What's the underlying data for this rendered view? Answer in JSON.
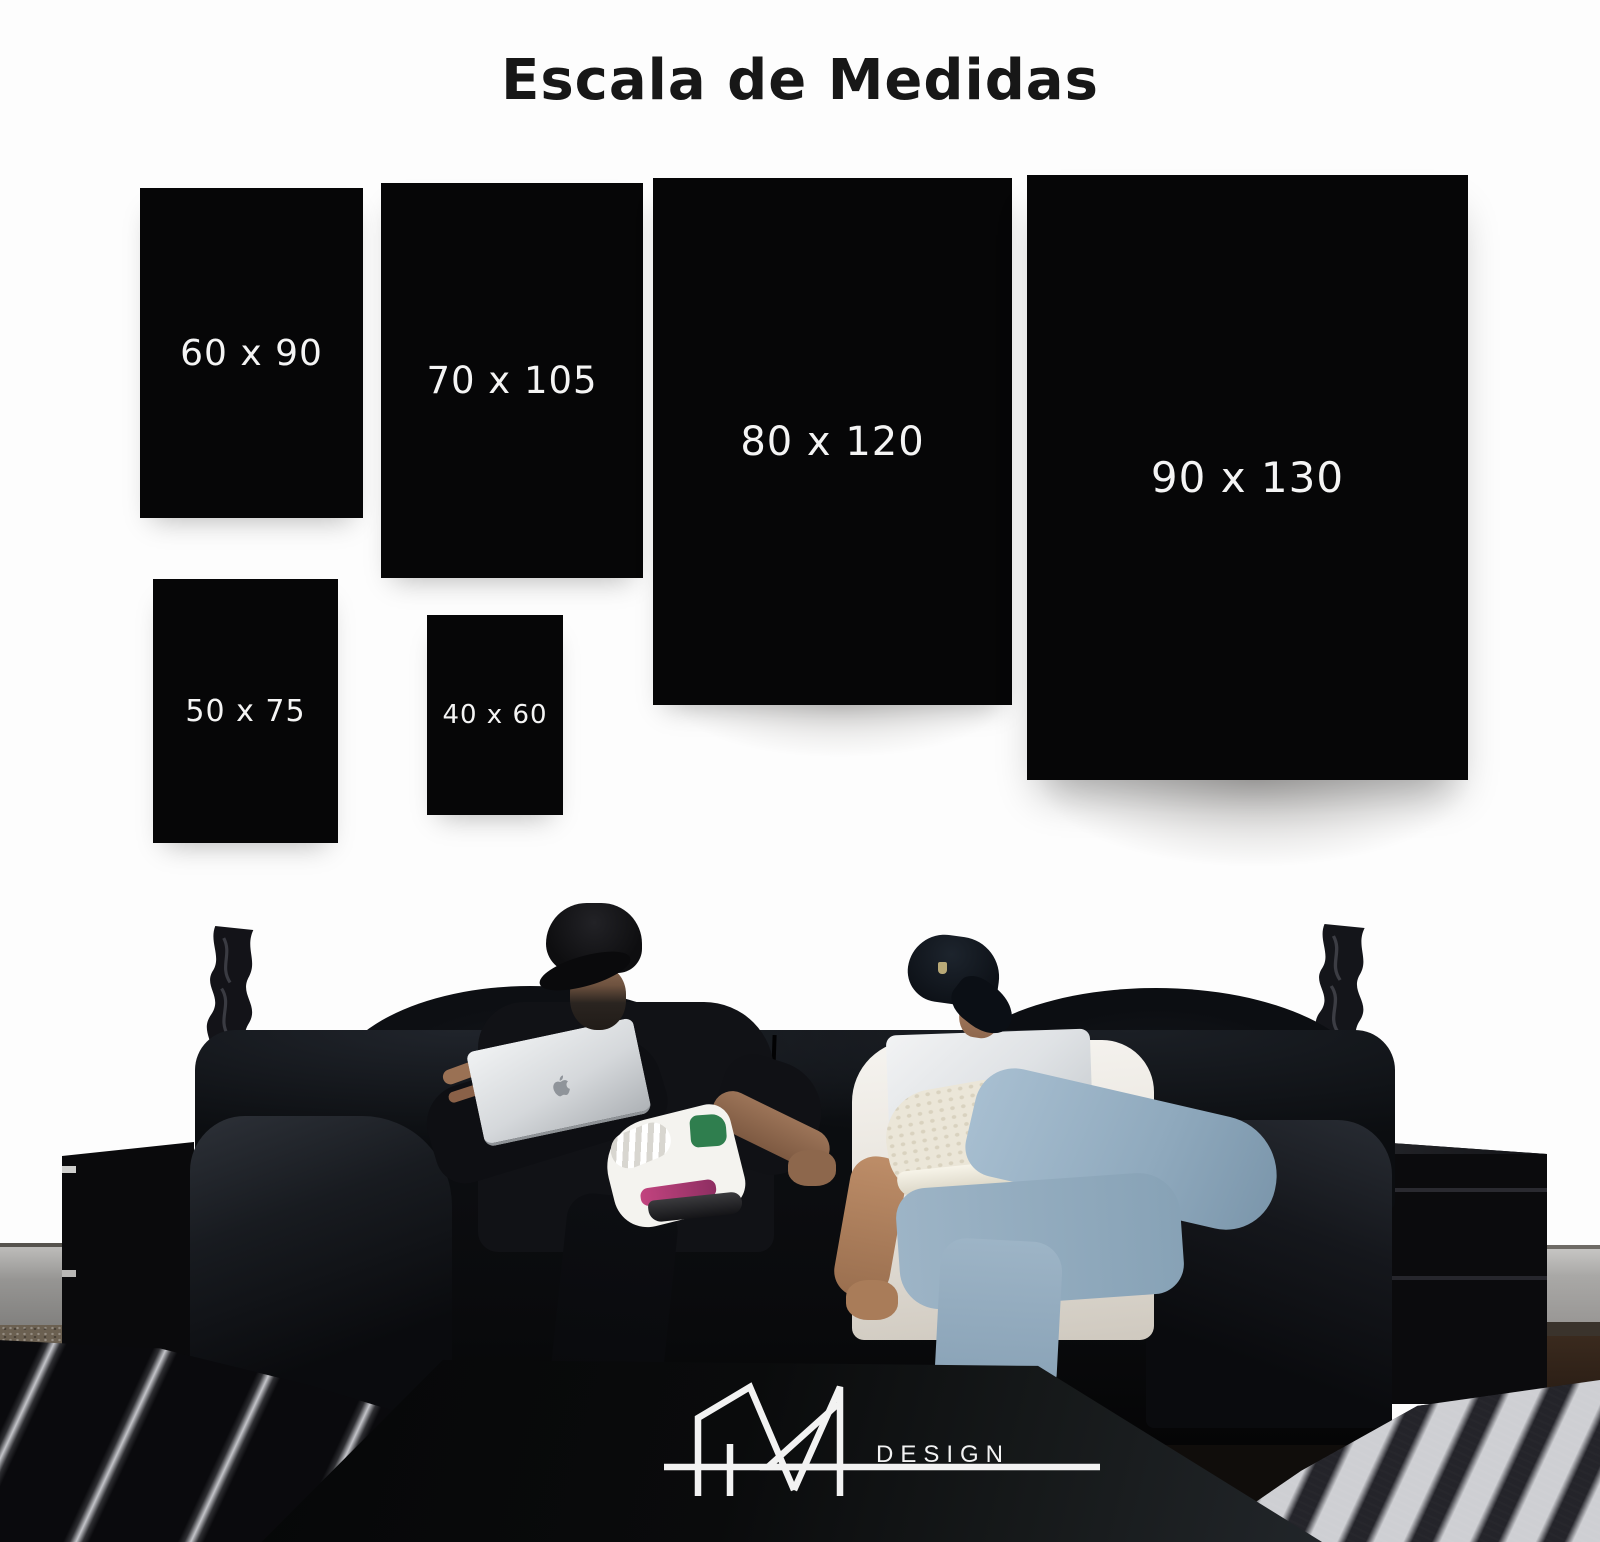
{
  "title": "Escala de Medidas",
  "chart_data": {
    "type": "table",
    "title": "Escala de Medidas",
    "unit": "cm",
    "sizes": [
      {
        "label": "60 x 90",
        "width_cm": 60,
        "height_cm": 90
      },
      {
        "label": "70 x 105",
        "width_cm": 70,
        "height_cm": 105
      },
      {
        "label": "80 x 120",
        "width_cm": 80,
        "height_cm": 120
      },
      {
        "label": "90 x 130",
        "width_cm": 90,
        "height_cm": 130
      },
      {
        "label": "50 x 75",
        "width_cm": 50,
        "height_cm": 75
      },
      {
        "label": "40 x 60",
        "width_cm": 40,
        "height_cm": 60
      }
    ]
  },
  "brand": {
    "wordmark": "DESIGN"
  },
  "colors": {
    "background": "#fdfdfd",
    "swatch": "#060607",
    "swatch_label": "#f4f4f4",
    "title_text": "#171717",
    "logo_white": "#f2f2f2"
  }
}
